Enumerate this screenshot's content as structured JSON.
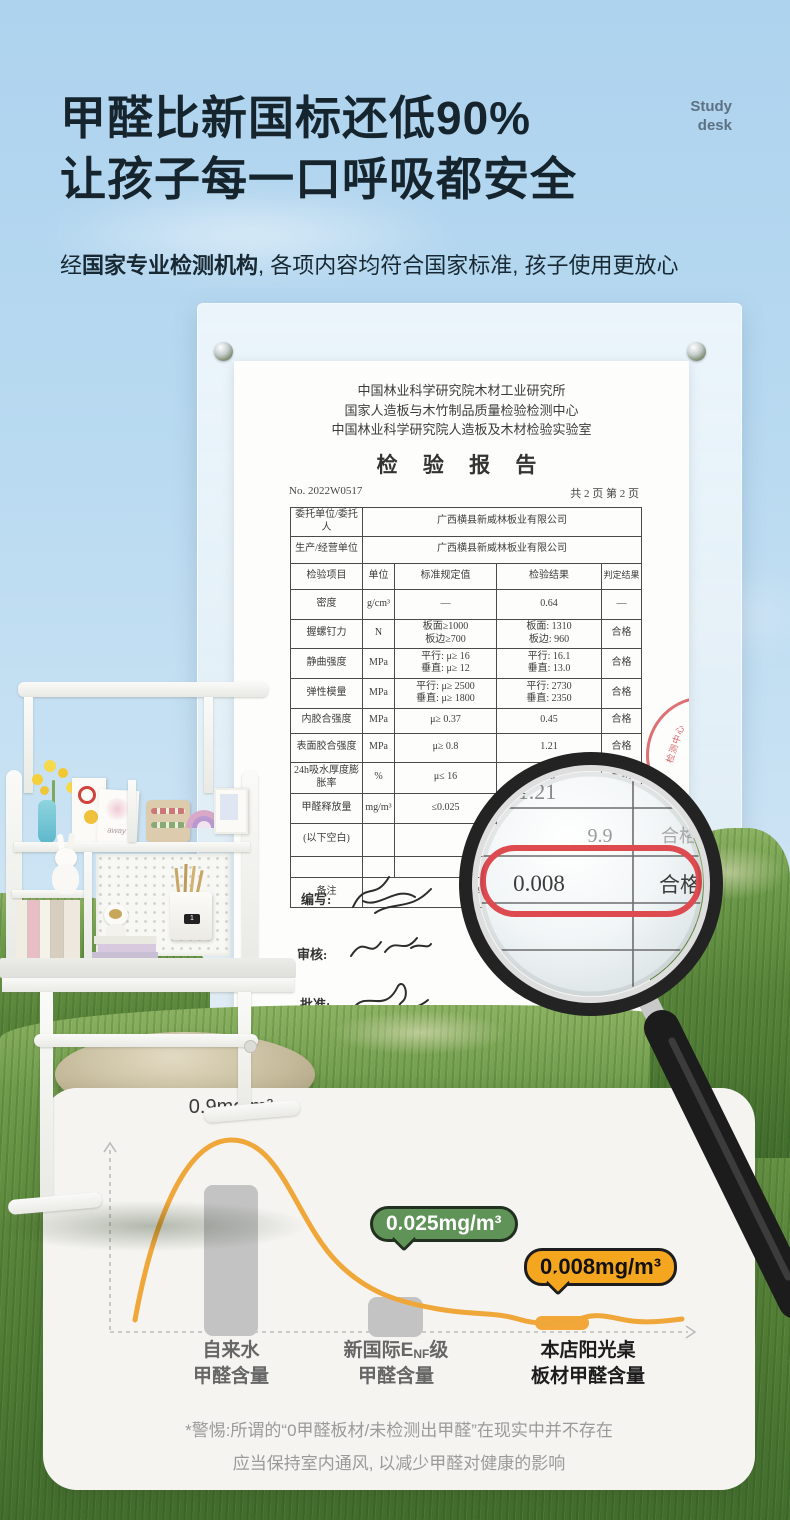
{
  "header": {
    "title_line1": "甲醛比新国标还低90%",
    "title_line2": "让孩子每一口呼吸都安全",
    "corner_line1": "Study",
    "corner_line2": "desk",
    "subtitle_prefix": "经",
    "subtitle_bold": "国家专业检测机构",
    "subtitle_rest": ", 各项内容均符合国家标准, 孩子使用更放心"
  },
  "report": {
    "org_line1": "中国林业科学研究院木材工业研究所",
    "org_line2": "国家人造板与木竹制品质量检验检测中心",
    "org_line3": "中国林业科学研究院人造板及木材检验实验室",
    "title": "检 验 报 告",
    "report_no": "No. 2022W0517",
    "page_info": "共 2 页  第 2 页",
    "client_label": "委托单位/委托人",
    "client_value": "广西横县新威林板业有限公司",
    "producer_label": "生产/经营单位",
    "producer_value": "广西横县新威林板业有限公司",
    "col_item": "检验项目",
    "col_unit": "单位",
    "col_standard": "标准规定值",
    "col_result": "检验结果",
    "col_judge": "判定结果",
    "rows": [
      {
        "item": "密度",
        "unit": "g/cm³",
        "standard": "—",
        "result": "0.64",
        "judge": "—"
      },
      {
        "item": "握螺钉力",
        "unit": "N",
        "standard": "板面≥1000\n板边≥700",
        "result": "板面: 1310\n板边: 960",
        "judge": "合格"
      },
      {
        "item": "静曲强度",
        "unit": "MPa",
        "standard": "平行: μ≥ 16\n垂直: μ≥ 12",
        "result": "平行: 16.1\n垂直: 13.0",
        "judge": "合格"
      },
      {
        "item": "弹性模量",
        "unit": "MPa",
        "standard": "平行: μ≥ 2500\n垂直: μ≥ 1800",
        "result": "平行: 2730\n垂直: 2350",
        "judge": "合格"
      },
      {
        "item": "内胶合强度",
        "unit": "MPa",
        "standard": "μ≥ 0.37",
        "result": "0.45",
        "judge": "合格"
      },
      {
        "item": "表面胶合强度",
        "unit": "MPa",
        "standard": "μ≥ 0.8",
        "result": "1.21",
        "judge": "合格"
      },
      {
        "item": "24h吸水厚度膨胀率",
        "unit": "%",
        "standard": "μ≤ 16",
        "result": "9.9",
        "judge": "合格"
      },
      {
        "item": "甲醛释放量",
        "unit": "mg/m³",
        "standard": "≤0.025",
        "result": "",
        "judge": ""
      },
      {
        "item": "(以下空白)",
        "unit": "",
        "standard": "",
        "result": "",
        "judge": ""
      },
      {
        "item": "",
        "unit": "",
        "standard": "",
        "result": "",
        "judge": ""
      }
    ],
    "remark_label": "备注",
    "remark_value": "本报告所检…",
    "sign_write": "编写:",
    "sign_review": "审核:",
    "sign_approve": "批准:"
  },
  "magnifier": {
    "top_value": "1.21",
    "mid_value": "9.9",
    "mid_judge": "合格",
    "main_value": "0.008",
    "main_judge": "合格"
  },
  "chart": {
    "bar1_label": "0.9mg/m³",
    "bubble_green": "0.025mg/m³",
    "bubble_orange": "0.008mg/m³",
    "cat1_line1": "自来水",
    "cat1_line2": "甲醛含量",
    "cat2_pre": "新国际E",
    "cat2_sub": "NF",
    "cat2_post": "级",
    "cat2_line2": "甲醛含量",
    "cat3_line1": "本店阳光桌",
    "cat3_line2": "板材甲醛含量"
  },
  "chart_data": {
    "type": "bar",
    "overlay": "line",
    "categories": [
      "自来水甲醛含量",
      "新国际ENF级甲醛含量",
      "本店阳光桌板材甲醛含量"
    ],
    "values": [
      0.9,
      0.025,
      0.008
    ],
    "unit": "mg/m³",
    "annotations": [
      "0.9mg/m³",
      "0.025mg/m³",
      "0.008mg/m³"
    ],
    "title": "",
    "xlabel": "",
    "ylabel": "",
    "grid": false,
    "legend": false,
    "bar_colors": [
      "#c3c3c3",
      "#c3c3c3",
      "#f2a738"
    ],
    "line_color": "#f0a73a"
  },
  "footnote": {
    "line1": "*警惕:所谓的“0甲醛板材/未检测出甲醛”在现实中并不存在",
    "line2": "应当保持室内通风, 以减少甲醛对健康的影响"
  },
  "colors": {
    "accent_orange": "#f5a61f",
    "accent_green": "#5f9358",
    "alert_red": "#dd4a50",
    "title_text": "#16242e",
    "sky_blue": "#b7d9f0",
    "grass_green": "#588439"
  }
}
